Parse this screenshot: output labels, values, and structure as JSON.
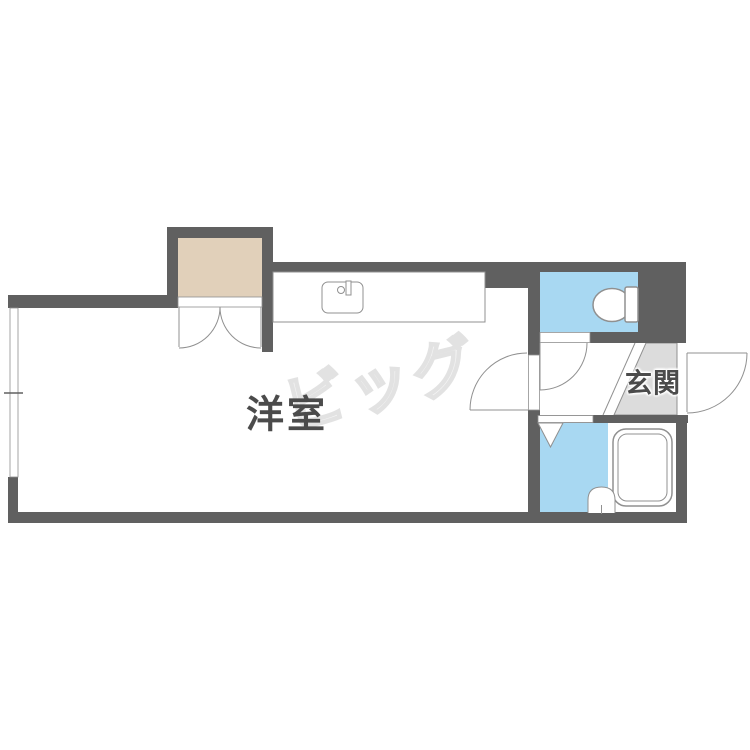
{
  "colors": {
    "wall": "#606060",
    "line": "#909090",
    "water": "#a8d8f2",
    "closet": "#e1d0ba",
    "genkan": "#dcdcdc",
    "watermark": "#e2e2e2",
    "label": "#4b4b4b"
  },
  "labels": {
    "room": "洋室",
    "entrance": "玄関",
    "watermark": "ビッグ"
  }
}
